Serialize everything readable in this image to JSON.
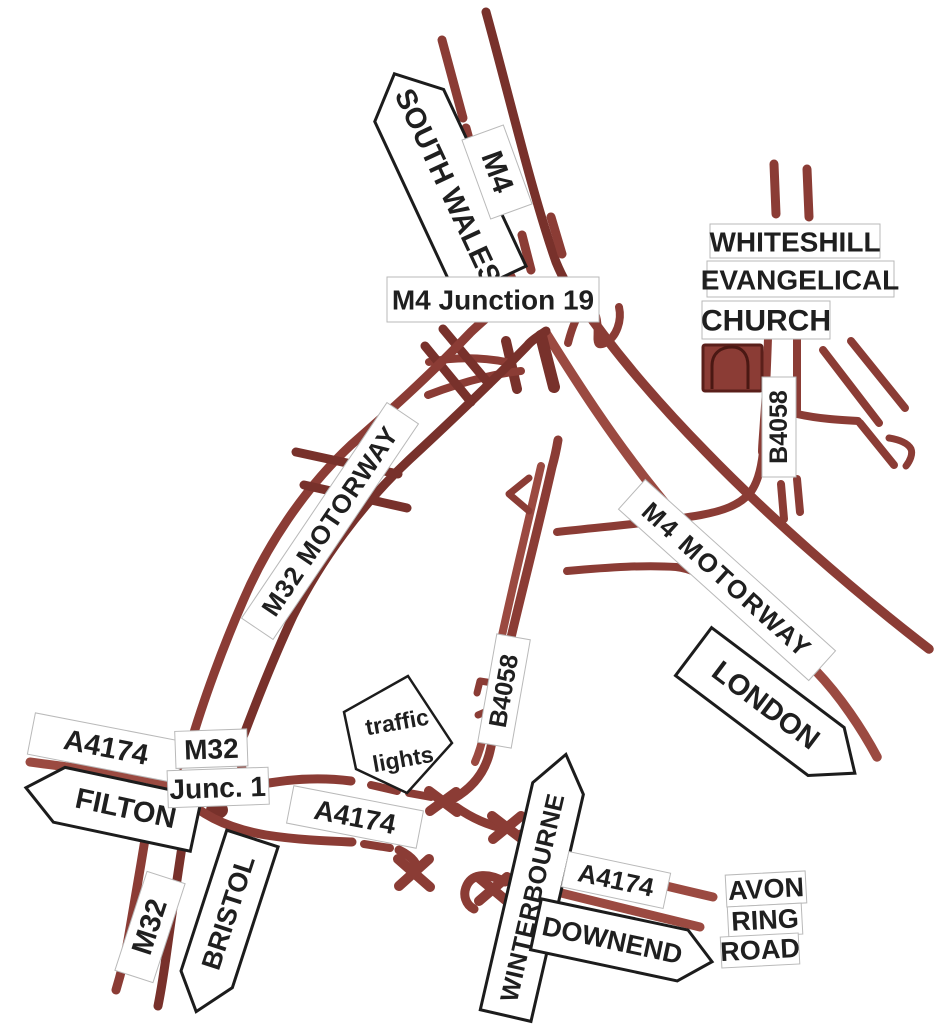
{
  "labels": {
    "south_wales": "SOUTH WALES",
    "m4_top": "M4",
    "m4_junction_19": "M4 Junction 19",
    "whiteshill": "WHITESHILL",
    "evangelical": "EVANGELICAL",
    "church": "CHURCH",
    "b4058_church": "B4058",
    "m32_motorway": "M32 MOTORWAY",
    "m4_motorway": "M4 MOTORWAY",
    "london": "LONDON",
    "b4058_south": "B4058",
    "traffic": "traffic",
    "lights": "lights",
    "a4174_west": "A4174",
    "filton": "FILTON",
    "m32_junc_line1": "M32",
    "m32_junc_line2": "Junc. 1",
    "a4174_mid": "A4174",
    "m32_south": "M32",
    "bristol": "BRISTOL",
    "winterbourne": "WINTERBOURNE",
    "downend": "DOWNEND",
    "a4174_east": "A4174",
    "avon": "AVON",
    "ring": "RING",
    "road": "ROAD"
  },
  "colors": {
    "road": "#8b3c35",
    "road_dark": "#78312b",
    "road_light": "#9b4a41",
    "sign_border": "#1c1c1c",
    "text": "#1f1f1f",
    "background": "#ffffff"
  }
}
